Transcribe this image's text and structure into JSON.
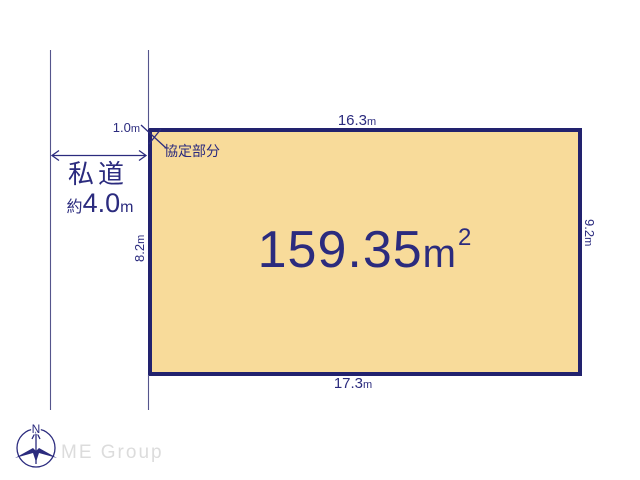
{
  "colors": {
    "ink_navy": "#2b2b7e",
    "border_navy": "#22226e",
    "plot_fill": "#f8db9a",
    "thin_line": "#55558c",
    "logo_gray": "#dcdcdc",
    "background": "#ffffff"
  },
  "plot": {
    "area": {
      "value": "159.35",
      "unit": "m",
      "sup": "2"
    },
    "dim_top": {
      "value": "16.3",
      "unit": "m"
    },
    "dim_bottom": {
      "value": "17.3",
      "unit": "m"
    },
    "dim_left": {
      "value": "8.2",
      "unit": "m"
    },
    "dim_right": {
      "value": "9.2",
      "unit": "m"
    }
  },
  "road": {
    "name": "私道",
    "width_prefix": "約",
    "width_value": "4.0",
    "width_unit": "m"
  },
  "agreement": {
    "offset_value": "1.0",
    "offset_unit": "m",
    "label": "協定部分"
  },
  "compass": {
    "north_label": "N"
  },
  "footer": {
    "logo_text": "ME Group"
  }
}
